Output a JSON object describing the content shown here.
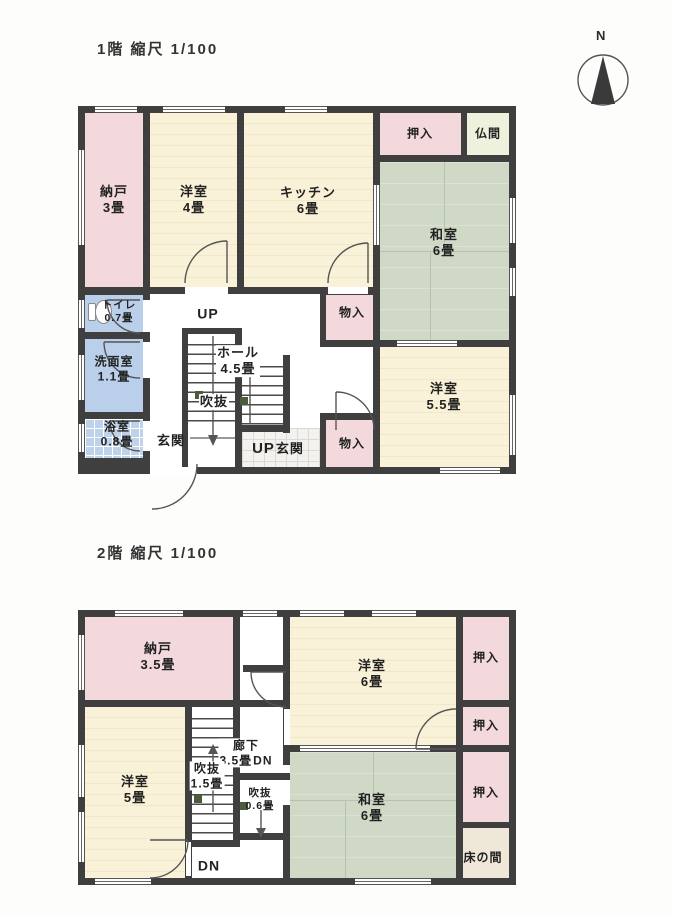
{
  "document": {
    "floor1_title": "1階 縮尺 1/100",
    "floor2_title": "2階 縮尺 1/100",
    "compass_label": "N"
  },
  "colors": {
    "wall": "#3f3f3f",
    "closet_pink": "#f3d8dc",
    "wood_cream": "#faf2d8",
    "tatami_green": "#cfd9c6",
    "water_blue": "#bacfe9",
    "butsuma_cream": "#eef2dc",
    "tokonoma_beige": "#efe8d9",
    "tile_white": "#f3f2ee"
  },
  "floor1": {
    "rooms": {
      "nando": {
        "name": "納戸",
        "size": "3畳"
      },
      "youshitsu4": {
        "name": "洋室",
        "size": "4畳"
      },
      "kitchen": {
        "name": "キッチン",
        "size": "6畳"
      },
      "oshiire": {
        "name": "押入"
      },
      "butsuma": {
        "name": "仏間"
      },
      "washitsu": {
        "name": "和室",
        "size": "6畳"
      },
      "toilet": {
        "name": "トイレ",
        "size": "0.7畳"
      },
      "monoire_upper": {
        "name": "物入"
      },
      "senmen": {
        "name": "洗面室",
        "size": "1.1畳"
      },
      "hall": {
        "name": "ホール",
        "size": "4.5畳"
      },
      "fukinuke": {
        "name": "吹抜"
      },
      "yokushitsu": {
        "name": "浴室",
        "size": "0.8畳"
      },
      "genkan": {
        "name": "玄関"
      },
      "up": "UP",
      "up_genkan": {
        "up": "UP",
        "name": "玄関"
      },
      "monoire_lower": {
        "name": "物入"
      },
      "youshitsu55": {
        "name": "洋室",
        "size": "5.5畳"
      }
    }
  },
  "floor2": {
    "rooms": {
      "nando": {
        "name": "納戸",
        "size": "3.5畳"
      },
      "youshitsu6": {
        "name": "洋室",
        "size": "6畳"
      },
      "oshiire1": {
        "name": "押入"
      },
      "oshiire2": {
        "name": "押入"
      },
      "rouka": {
        "name": "廊下",
        "size": "3.5畳"
      },
      "dn_upper": "DN",
      "fukinuke15": {
        "name": "吹抜",
        "size": "1.5畳"
      },
      "fukinuke06": {
        "name": "吹抜",
        "size": "0.6畳"
      },
      "youshitsu5": {
        "name": "洋室",
        "size": "5畳"
      },
      "washitsu": {
        "name": "和室",
        "size": "6畳"
      },
      "oshiire3": {
        "name": "押入"
      },
      "tokonoma": {
        "name": "床の間"
      },
      "dn_lower": "DN"
    }
  }
}
